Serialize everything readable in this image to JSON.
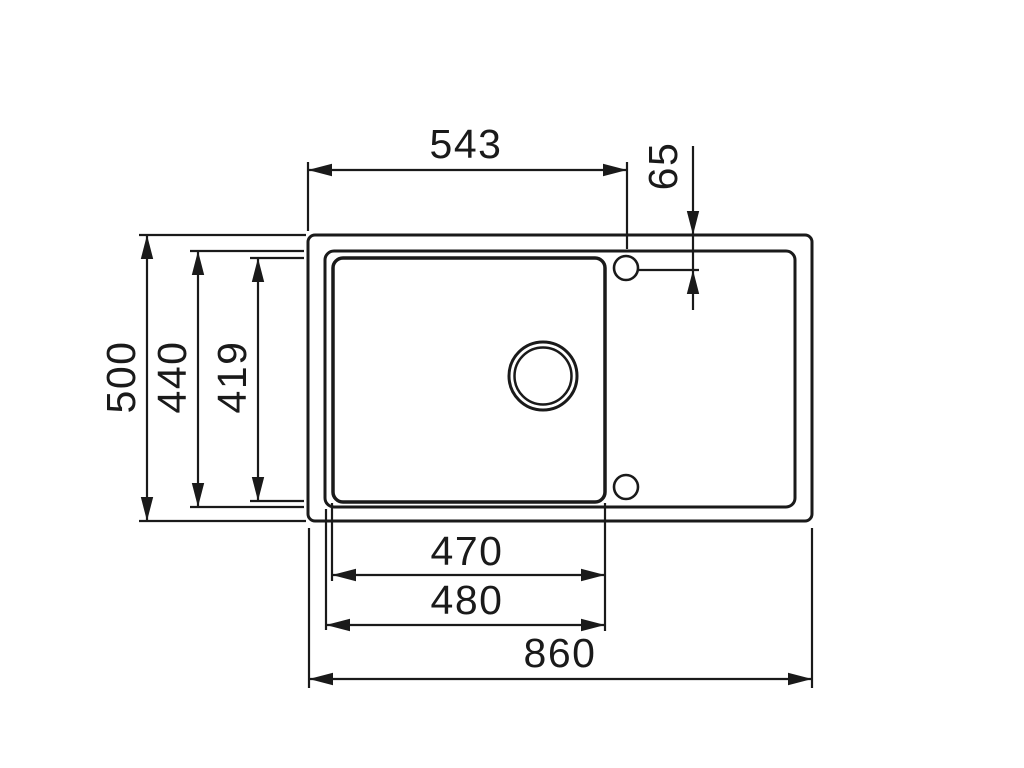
{
  "drawing": {
    "background_color": "#ffffff",
    "line_color": "#1a1a1a",
    "labels": {
      "top_width": "543",
      "faucet_offset": "65",
      "overall_depth": "500",
      "rim_depth": "440",
      "bowl_depth": "419",
      "bowl_width": "470",
      "cutout_width": "480",
      "overall_width": "860"
    }
  }
}
